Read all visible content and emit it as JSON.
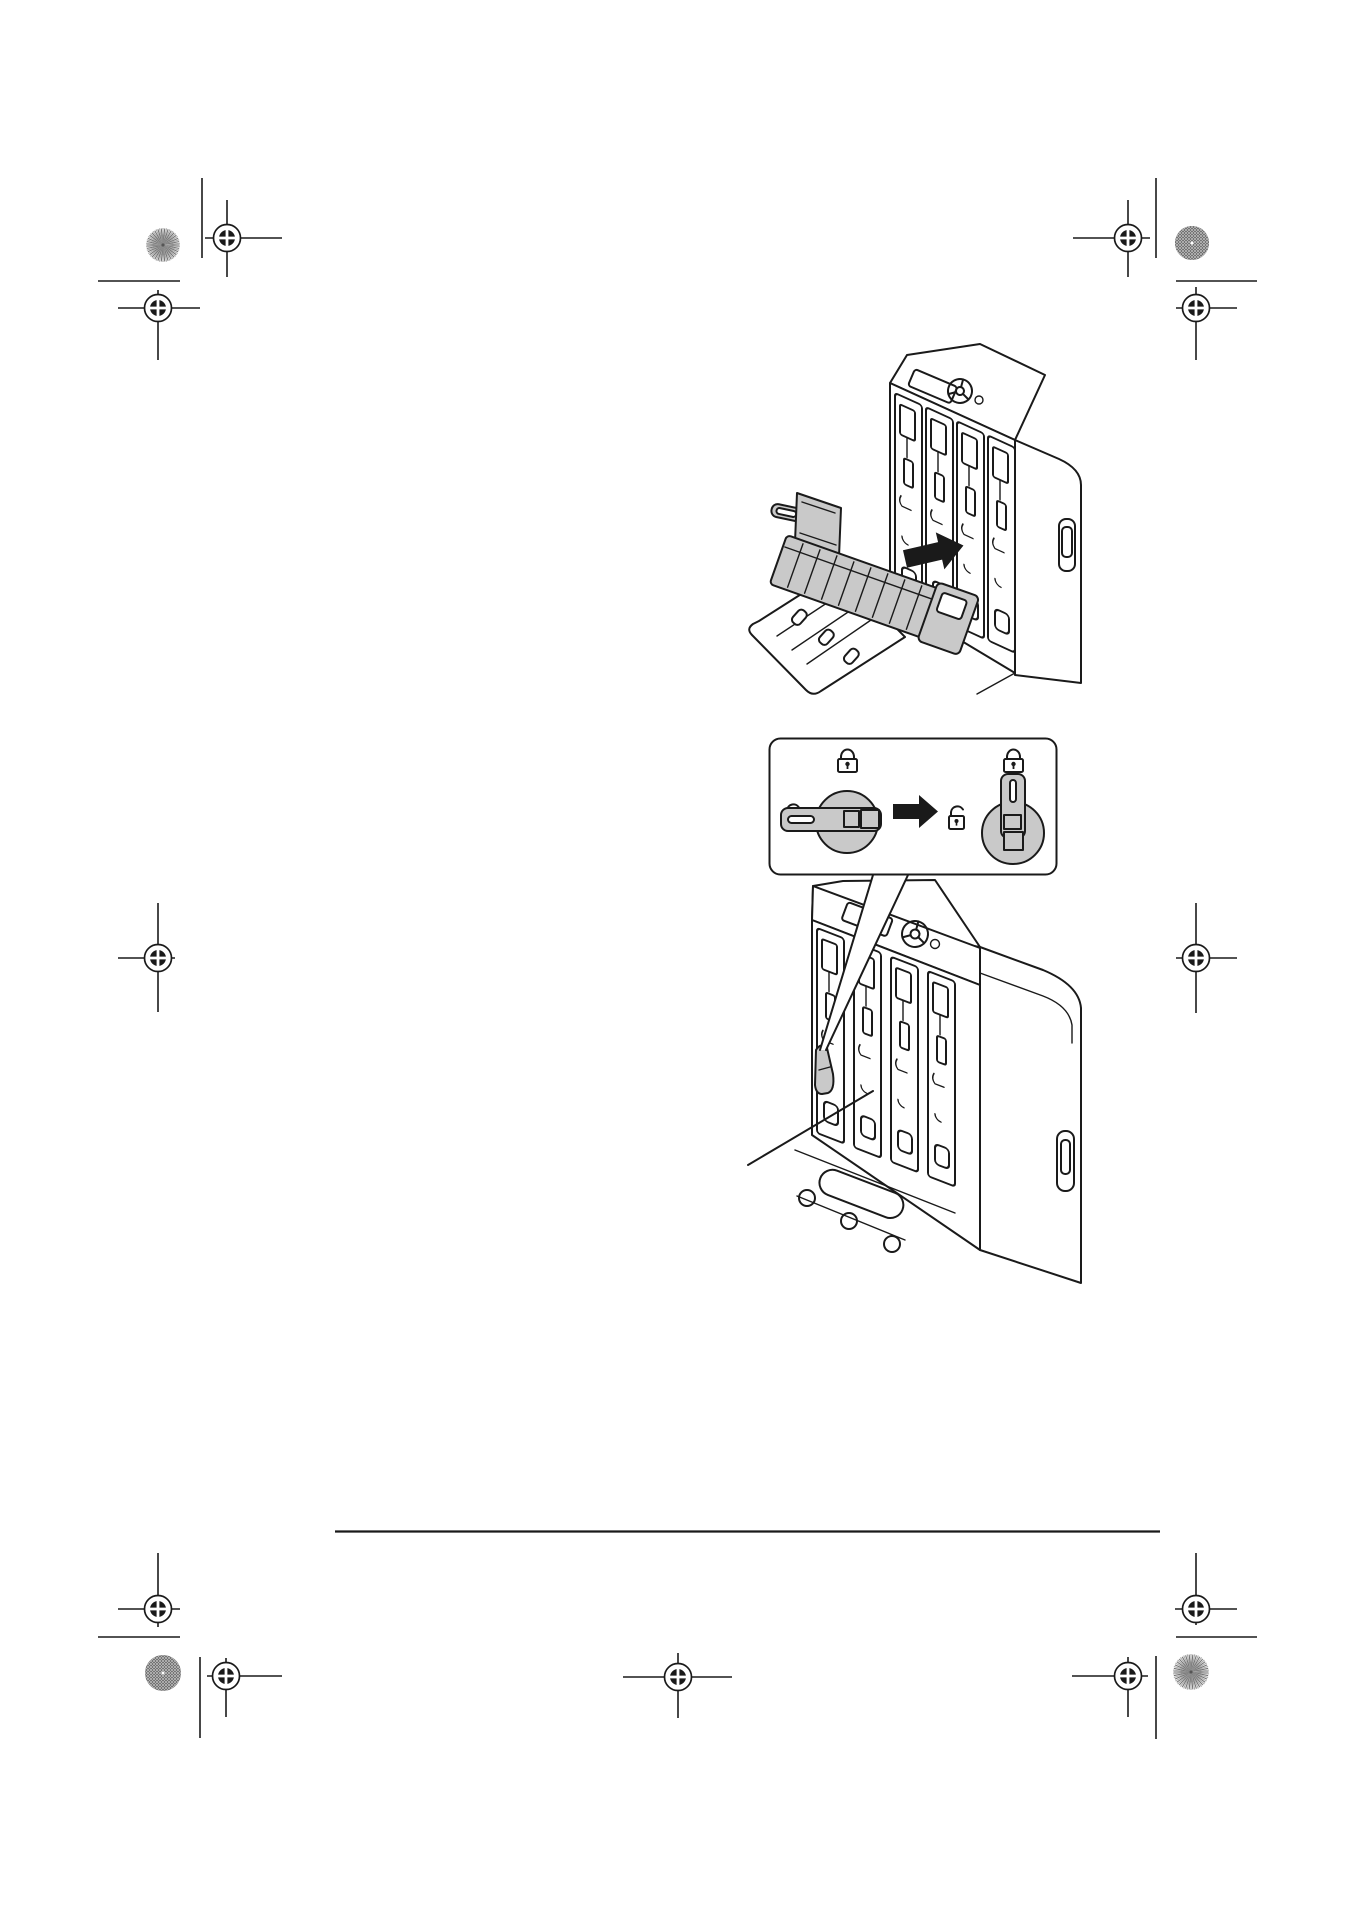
{
  "page": {
    "width": 1355,
    "height": 1917,
    "background": "#ffffff",
    "text_content": ""
  },
  "colors": {
    "ink": "#1a1a1a",
    "part_gray": "#c9c9c9",
    "starburst_gray_a": "#6f6f6f",
    "starburst_gray_b": "#a8a8a8",
    "crosshatch_dark": "#474747",
    "crosshatch_light": "#b9b9b9",
    "paper": "#ffffff"
  },
  "print_marks": {
    "registration_marks": [
      [
        227,
        238,
        205,
        282,
        200,
        277
      ],
      [
        158,
        308,
        118,
        200,
        290,
        360
      ],
      [
        1128,
        238,
        1073,
        1150,
        200,
        277
      ],
      [
        1196,
        308,
        1176,
        1237,
        287,
        360
      ],
      [
        158,
        958,
        118,
        175,
        903,
        1012
      ],
      [
        1196,
        958,
        1176,
        1237,
        903,
        1013
      ],
      [
        158,
        1609,
        118,
        180,
        1553,
        1627
      ],
      [
        226,
        1676,
        207,
        282,
        1658,
        1717
      ],
      [
        678,
        1677,
        623,
        732,
        1653,
        1718
      ],
      [
        1196,
        1609,
        1175,
        1237,
        1553,
        1625
      ],
      [
        1128,
        1676,
        1072,
        1148,
        1657,
        1717
      ]
    ],
    "crop_lines": [
      [
        202,
        178,
        202,
        258
      ],
      [
        98,
        281,
        180,
        281
      ],
      [
        1156,
        178,
        1156,
        258
      ],
      [
        1176,
        281,
        1257,
        281
      ],
      [
        98,
        1637,
        180,
        1637
      ],
      [
        200,
        1657,
        200,
        1738
      ],
      [
        1176,
        1637,
        1257,
        1637
      ],
      [
        1156,
        1656,
        1156,
        1739
      ]
    ],
    "color_targets": [
      {
        "style": "starburst",
        "x": 163,
        "y": 245,
        "r": 17
      },
      {
        "style": "crosshatch",
        "x": 1192,
        "y": 243,
        "r": 17
      },
      {
        "style": "crosshatch",
        "x": 163,
        "y": 1673,
        "r": 18
      },
      {
        "style": "starburst",
        "x": 1191,
        "y": 1672,
        "r": 18
      }
    ],
    "footer_rule": [
      335,
      1531.5,
      1160,
      1531.5
    ]
  },
  "figures": {
    "step_insert": {
      "name": "insert-waste-toner-box-illustration",
      "parts": [
        "printer-front-open",
        "imaging-unit-slots",
        "waste-toner-box",
        "insert-direction-arrow",
        "open-front-cover"
      ]
    },
    "lock_diagram": {
      "name": "lock-lever-rotation-diagram",
      "icons": [
        "lock-closed-icon",
        "lock-open-icon",
        "arrow-right-icon",
        "lock-open-icon",
        "lock-closed-icon"
      ],
      "left_dial_state": "lever-horizontal-unlocked",
      "right_dial_state": "lever-vertical-locked"
    },
    "step_lock": {
      "name": "rotate-lock-lever-illustration",
      "parts": [
        "printer-front",
        "imaging-unit-slots",
        "lock-lever",
        "callout-pointer",
        "front-cover-tray"
      ]
    }
  }
}
